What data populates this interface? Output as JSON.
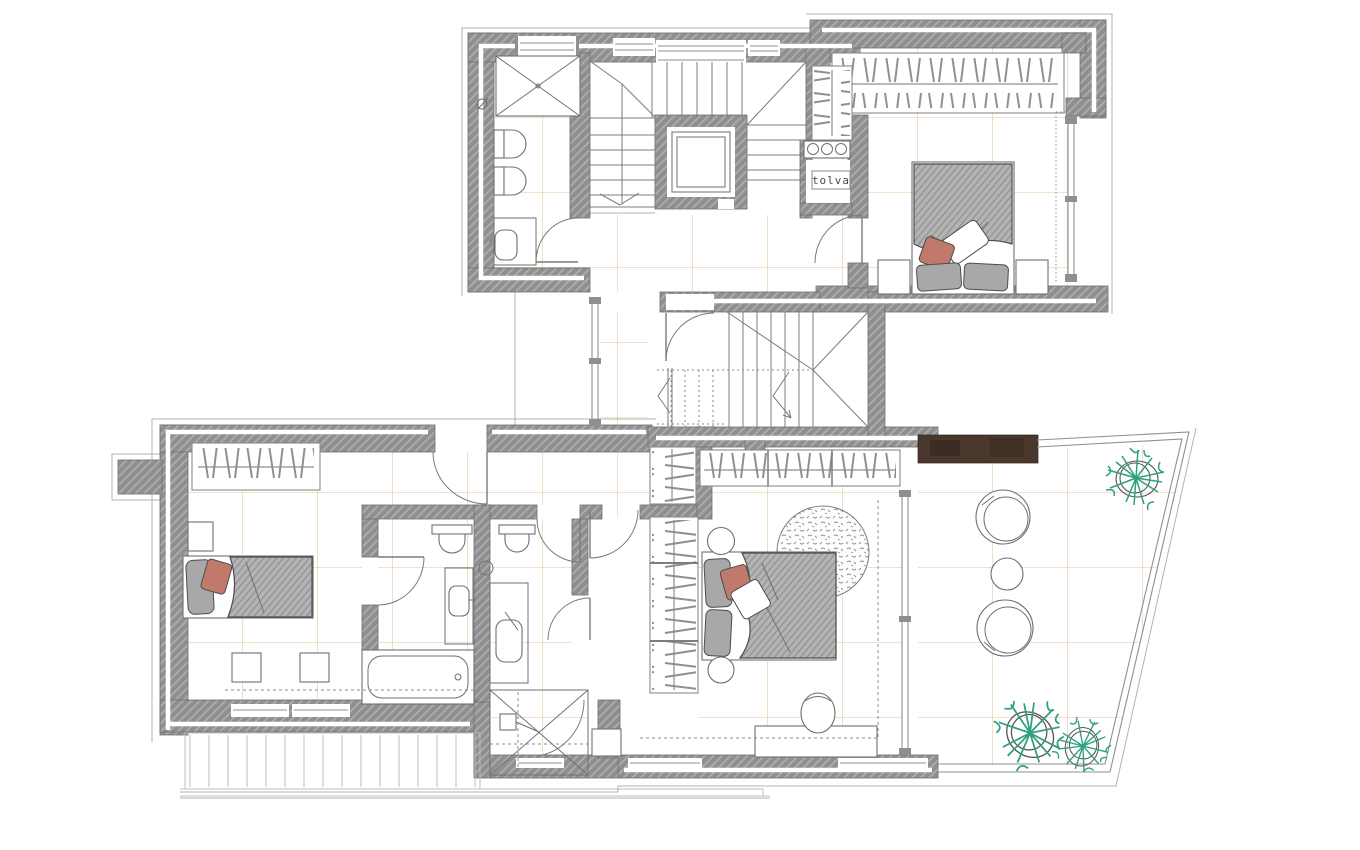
{
  "labels": {
    "chute": "tolva"
  },
  "colors": {
    "wall": "#8f8f8f",
    "wall_hatch": "#adadad",
    "wall_edge": "#6e6e6e",
    "line": "#6f6f6f",
    "grid": "#e7cfa6",
    "duvet": "#b4b4b4",
    "duvet_hatch": "#939393",
    "pillow": "#a8a8a8",
    "accent_pillow": "#bf7a6c",
    "plant": "#2fa080",
    "wood": "#4a382c",
    "dash": "#8d8d8d",
    "deck": "#bdbdbd"
  }
}
